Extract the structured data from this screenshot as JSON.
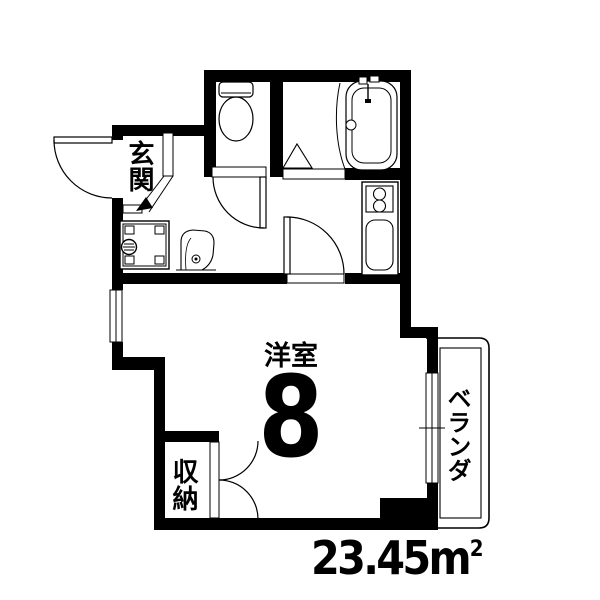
{
  "labels": {
    "entrance": "玄関",
    "main_room": "洋室",
    "main_room_size": "8",
    "storage": "収納",
    "veranda": "ベランダ"
  },
  "area": {
    "value": "23.45",
    "unit": "m",
    "sup": "2"
  },
  "fixtures": {
    "toilet": "toilet-icon",
    "bathtub": "bathtub-icon",
    "bath_folding_door": "folding-door-icon",
    "stove": "stove-burners-icon",
    "kitchen_sink": "kitchen-sink-icon",
    "washing_machine_pan": "washing-machine-pan-icon",
    "wash_basin": "wash-basin-icon"
  },
  "colors": {
    "wall": "#000000",
    "background": "#ffffff",
    "line": "#000000"
  }
}
